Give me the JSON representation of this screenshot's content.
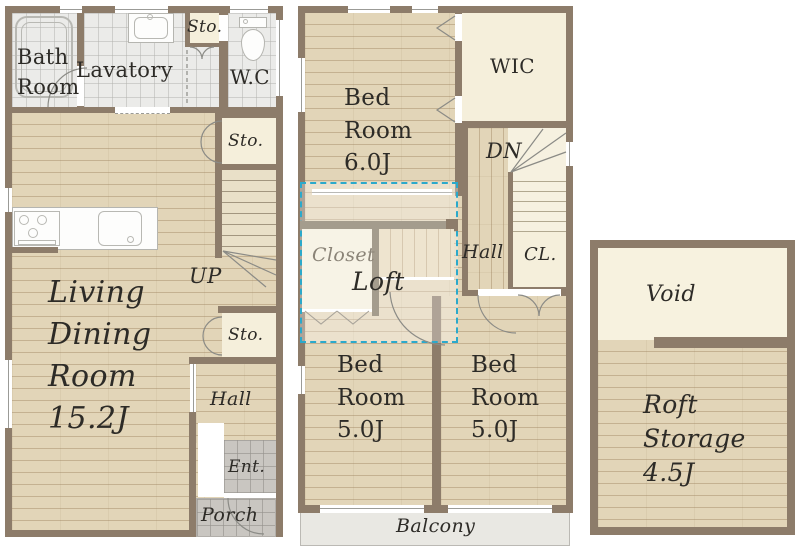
{
  "colors": {
    "wall": "#8d7c6a",
    "wood_floor": "#e2d5b8",
    "cream_room": "#f5efdb",
    "tile_room": "#ebebe9",
    "entry_tile": "#c9c6c1",
    "balcony": "#e9e8e3",
    "loft_outline": "#2ba9cb",
    "label_text": "#2d2b27",
    "closet_text": "#8b8478"
  },
  "floor1": {
    "bath": "Bath\nRoom",
    "lavatory": "Lavatory",
    "sto_top": "Sto.",
    "wc": "W.C",
    "sto_upper": "Sto.",
    "up": "UP",
    "sto_mid": "Sto.",
    "living": "Living\nDining\nRoom\n15.2J",
    "hall": "Hall",
    "ent": "Ent.",
    "porch": "Porch"
  },
  "floor2": {
    "bed_main": "Bed\nRoom\n6.0J",
    "wic": "WIC",
    "dn": "DN",
    "closet": "Closet",
    "loft": "Loft",
    "hall": "Hall",
    "cl": "CL.",
    "bed_left": "Bed\nRoom\n5.0J",
    "bed_right": "Bed\nRoom\n5.0J",
    "balcony": "Balcony"
  },
  "loft_floor": {
    "void": "Void",
    "storage": "Roft\nStorage\n4.5J"
  }
}
